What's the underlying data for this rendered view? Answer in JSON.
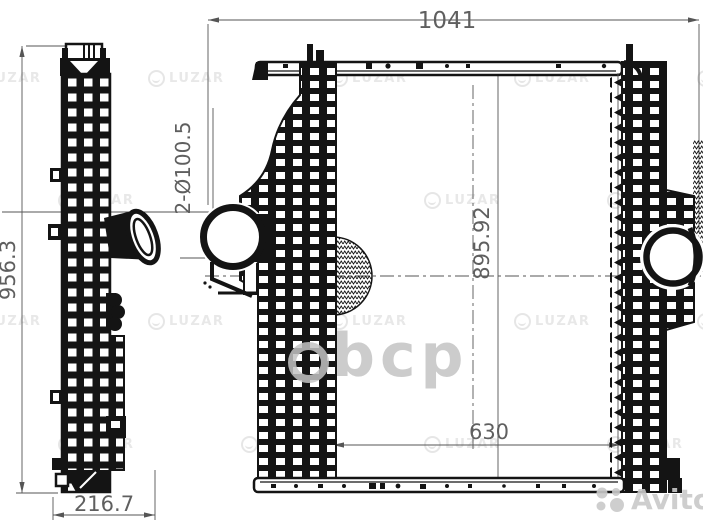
{
  "drawing": {
    "title": "intercooler-technical-drawing",
    "dimensions": {
      "overall_width": "1041",
      "side_overall_height": "956.3",
      "side_depth": "216.7",
      "core_height": "895.92",
      "mount_width": "630",
      "port_callout": "2-Ø100.5"
    }
  },
  "watermarks": {
    "brand_logo": "LUZAR",
    "center_mark": "bcp",
    "marketplace": "Avito"
  },
  "colors": {
    "line_black": "#141414",
    "dim_gray": "#5f5f5f",
    "watermark_gray": "#c9c9c9"
  }
}
